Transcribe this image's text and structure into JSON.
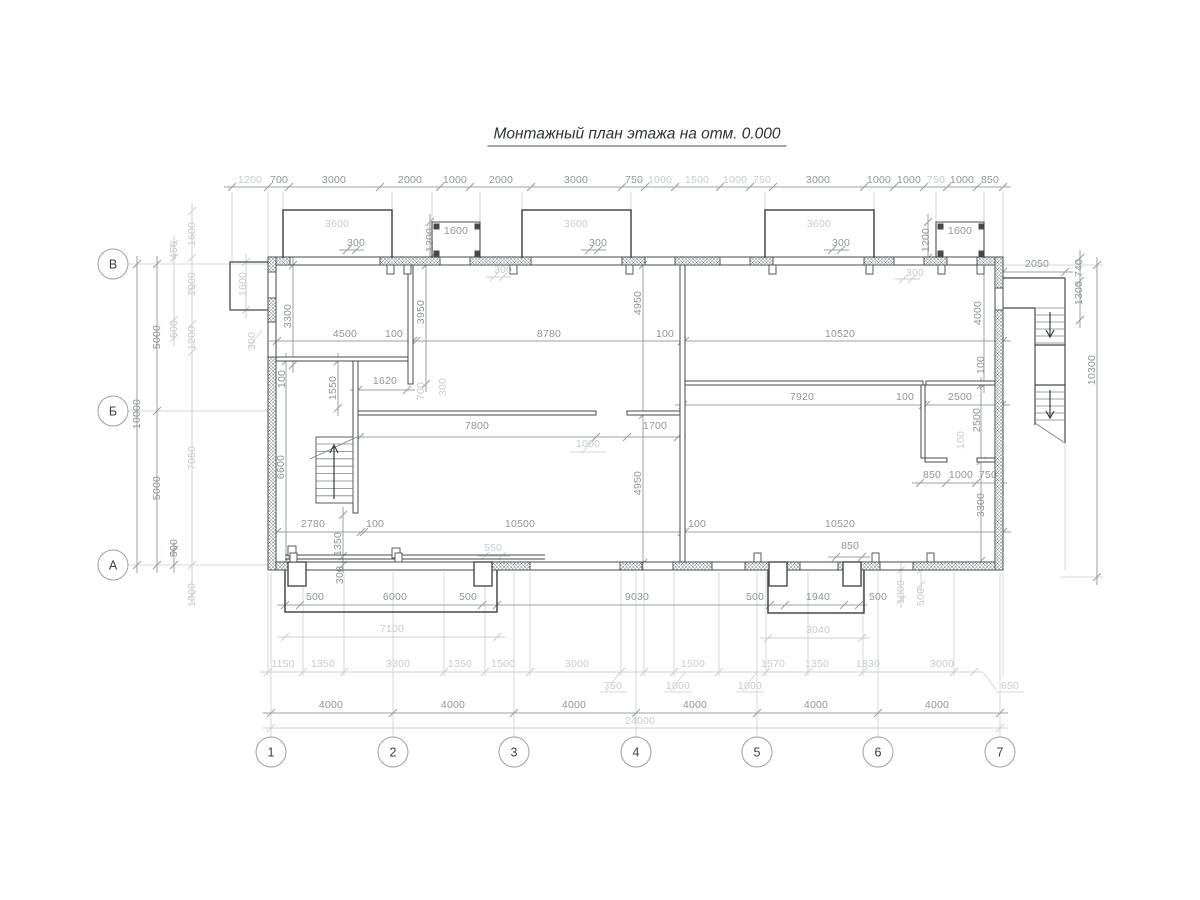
{
  "title": "Монтажный план этажа на отм. 0.000",
  "axes": {
    "vertical": [
      "В",
      "Б",
      "А"
    ],
    "horizontal": [
      "1",
      "2",
      "3",
      "4",
      "5",
      "6",
      "7"
    ]
  },
  "colors": {
    "wall_line": "#45494c",
    "dim_dark": "#8f9497",
    "dim_light": "#c7cbcd",
    "hatch": "#6e7376",
    "title_text": "#2e3234"
  },
  "labels": [
    {
      "t": "1200",
      "x": 250,
      "y": 180,
      "l": 1
    },
    {
      "t": "700",
      "x": 279,
      "y": 180
    },
    {
      "t": "3000",
      "x": 334,
      "y": 180
    },
    {
      "t": "2000",
      "x": 410,
      "y": 180
    },
    {
      "t": "1000",
      "x": 455,
      "y": 180
    },
    {
      "t": "2000",
      "x": 501,
      "y": 180
    },
    {
      "t": "3000",
      "x": 576,
      "y": 180
    },
    {
      "t": "750",
      "x": 634,
      "y": 180
    },
    {
      "t": "1000",
      "x": 660,
      "y": 180,
      "l": 1
    },
    {
      "t": "1500",
      "x": 697,
      "y": 180,
      "l": 1
    },
    {
      "t": "1000",
      "x": 735,
      "y": 180,
      "l": 1
    },
    {
      "t": "750",
      "x": 762,
      "y": 180,
      "l": 1
    },
    {
      "t": "3000",
      "x": 818,
      "y": 180
    },
    {
      "t": "1000",
      "x": 879,
      "y": 180
    },
    {
      "t": "1000",
      "x": 909,
      "y": 180
    },
    {
      "t": "750",
      "x": 936,
      "y": 180,
      "l": 1
    },
    {
      "t": "1000",
      "x": 962,
      "y": 180
    },
    {
      "t": "850",
      "x": 990,
      "y": 180
    },
    {
      "t": "3600",
      "x": 337,
      "y": 224,
      "l": 1
    },
    {
      "t": "3600",
      "x": 576,
      "y": 224,
      "l": 1
    },
    {
      "t": "3600",
      "x": 819,
      "y": 224,
      "l": 1
    },
    {
      "t": "300",
      "x": 356,
      "y": 243
    },
    {
      "t": "300",
      "x": 598,
      "y": 243
    },
    {
      "t": "300",
      "x": 841,
      "y": 243
    },
    {
      "t": "1600",
      "x": 456,
      "y": 231
    },
    {
      "t": "1200",
      "x": 430,
      "y": 240,
      "r": 1
    },
    {
      "t": "1600",
      "x": 960,
      "y": 231
    },
    {
      "t": "1200",
      "x": 926,
      "y": 240,
      "r": 1
    },
    {
      "t": "300",
      "x": 503,
      "y": 270,
      "l": 1
    },
    {
      "t": "300",
      "x": 915,
      "y": 273,
      "l": 1
    },
    {
      "t": "1600",
      "x": 243,
      "y": 284,
      "r": 1,
      "l": 1
    },
    {
      "t": "300",
      "x": 252,
      "y": 341,
      "r": 1,
      "l": 1
    },
    {
      "t": "10000",
      "x": 137,
      "y": 414,
      "r": 1
    },
    {
      "t": "5000",
      "x": 157,
      "y": 337,
      "r": 1
    },
    {
      "t": "5000",
      "x": 157,
      "y": 488,
      "r": 1
    },
    {
      "t": "450",
      "x": 174,
      "y": 250,
      "r": 1,
      "l": 1
    },
    {
      "t": "600",
      "x": 174,
      "y": 329,
      "r": 1,
      "l": 1
    },
    {
      "t": "500",
      "x": 174,
      "y": 548,
      "r": 1
    },
    {
      "t": "1600",
      "x": 192,
      "y": 234,
      "r": 1,
      "l": 1
    },
    {
      "t": "1000",
      "x": 192,
      "y": 284,
      "r": 1,
      "l": 1
    },
    {
      "t": "1200",
      "x": 192,
      "y": 338,
      "r": 1,
      "l": 1
    },
    {
      "t": "7050",
      "x": 192,
      "y": 458,
      "r": 1,
      "l": 1
    },
    {
      "t": "1000",
      "x": 192,
      "y": 595,
      "r": 1,
      "l": 1
    },
    {
      "t": "3300",
      "x": 288,
      "y": 316,
      "r": 1
    },
    {
      "t": "100",
      "x": 282,
      "y": 379,
      "r": 1
    },
    {
      "t": "6600",
      "x": 281,
      "y": 467,
      "r": 1
    },
    {
      "t": "1550",
      "x": 333,
      "y": 388,
      "r": 1
    },
    {
      "t": "1350",
      "x": 338,
      "y": 544,
      "r": 1
    },
    {
      "t": "300",
      "x": 340,
      "y": 575,
      "r": 1
    },
    {
      "t": "4500",
      "x": 345,
      "y": 334
    },
    {
      "t": "100",
      "x": 394,
      "y": 334
    },
    {
      "t": "8780",
      "x": 549,
      "y": 334
    },
    {
      "t": "100",
      "x": 665,
      "y": 334
    },
    {
      "t": "10520",
      "x": 840,
      "y": 334
    },
    {
      "t": "3950",
      "x": 421,
      "y": 312,
      "r": 1
    },
    {
      "t": "4950",
      "x": 638,
      "y": 303,
      "r": 1
    },
    {
      "t": "4000",
      "x": 978,
      "y": 313,
      "r": 1
    },
    {
      "t": "1620",
      "x": 385,
      "y": 381
    },
    {
      "t": "700",
      "x": 421,
      "y": 391,
      "r": 1,
      "l": 1
    },
    {
      "t": "300",
      "x": 443,
      "y": 387,
      "r": 1,
      "l": 1
    },
    {
      "t": "7800",
      "x": 477,
      "y": 426
    },
    {
      "t": "1700",
      "x": 655,
      "y": 426
    },
    {
      "t": "1000",
      "x": 588,
      "y": 444,
      "l": 1
    },
    {
      "t": "7920",
      "x": 802,
      "y": 397
    },
    {
      "t": "100",
      "x": 905,
      "y": 397
    },
    {
      "t": "2500",
      "x": 960,
      "y": 397
    },
    {
      "t": "100",
      "x": 981,
      "y": 365,
      "r": 1
    },
    {
      "t": "2500",
      "x": 977,
      "y": 420,
      "r": 1
    },
    {
      "t": "100",
      "x": 961,
      "y": 440,
      "r": 1,
      "l": 1
    },
    {
      "t": "4950",
      "x": 638,
      "y": 483,
      "r": 1
    },
    {
      "t": "3300",
      "x": 981,
      "y": 505,
      "r": 1
    },
    {
      "t": "2780",
      "x": 313,
      "y": 524
    },
    {
      "t": "100",
      "x": 375,
      "y": 524
    },
    {
      "t": "10500",
      "x": 520,
      "y": 524
    },
    {
      "t": "100",
      "x": 697,
      "y": 524
    },
    {
      "t": "10520",
      "x": 840,
      "y": 524
    },
    {
      "t": "850",
      "x": 932,
      "y": 475
    },
    {
      "t": "1000",
      "x": 961,
      "y": 475
    },
    {
      "t": "750",
      "x": 988,
      "y": 475
    },
    {
      "t": "850",
      "x": 850,
      "y": 546
    },
    {
      "t": "550",
      "x": 493,
      "y": 548,
      "l": 1
    },
    {
      "t": "500",
      "x": 315,
      "y": 597
    },
    {
      "t": "6000",
      "x": 395,
      "y": 597
    },
    {
      "t": "500",
      "x": 468,
      "y": 597
    },
    {
      "t": "9030",
      "x": 637,
      "y": 597
    },
    {
      "t": "500",
      "x": 755,
      "y": 597
    },
    {
      "t": "1940",
      "x": 818,
      "y": 597
    },
    {
      "t": "500",
      "x": 878,
      "y": 597
    },
    {
      "t": "7100",
      "x": 392,
      "y": 629,
      "l": 1
    },
    {
      "t": "3040",
      "x": 818,
      "y": 630,
      "l": 1
    },
    {
      "t": "1000",
      "x": 901,
      "y": 592,
      "r": 1,
      "l": 1
    },
    {
      "t": "500",
      "x": 921,
      "y": 597,
      "r": 1,
      "l": 1
    },
    {
      "t": "1150",
      "x": 283,
      "y": 664,
      "l": 1
    },
    {
      "t": "1350",
      "x": 323,
      "y": 664,
      "l": 1
    },
    {
      "t": "3300",
      "x": 398,
      "y": 664,
      "l": 1
    },
    {
      "t": "1350",
      "x": 460,
      "y": 664,
      "l": 1
    },
    {
      "t": "1500",
      "x": 503,
      "y": 664,
      "l": 1
    },
    {
      "t": "3000",
      "x": 577,
      "y": 664,
      "l": 1
    },
    {
      "t": "1500",
      "x": 693,
      "y": 664,
      "l": 1
    },
    {
      "t": "1570",
      "x": 773,
      "y": 664,
      "l": 1
    },
    {
      "t": "1350",
      "x": 817,
      "y": 664,
      "l": 1
    },
    {
      "t": "1830",
      "x": 868,
      "y": 664,
      "l": 1
    },
    {
      "t": "3000",
      "x": 942,
      "y": 664,
      "l": 1
    },
    {
      "t": "750",
      "x": 613,
      "y": 686,
      "l": 1
    },
    {
      "t": "1000",
      "x": 678,
      "y": 686,
      "l": 1
    },
    {
      "t": "1000",
      "x": 750,
      "y": 686,
      "l": 1
    },
    {
      "t": "650",
      "x": 1010,
      "y": 686,
      "l": 1
    },
    {
      "t": "4000",
      "x": 331,
      "y": 705
    },
    {
      "t": "4000",
      "x": 453,
      "y": 705
    },
    {
      "t": "4000",
      "x": 574,
      "y": 705
    },
    {
      "t": "4000",
      "x": 695,
      "y": 705
    },
    {
      "t": "4000",
      "x": 816,
      "y": 705
    },
    {
      "t": "4000",
      "x": 937,
      "y": 705
    },
    {
      "t": "24000",
      "x": 640,
      "y": 721,
      "l": 1
    },
    {
      "t": "2050",
      "x": 1037,
      "y": 264
    },
    {
      "t": "740",
      "x": 1079,
      "y": 268,
      "r": 1
    },
    {
      "t": "1300",
      "x": 1079,
      "y": 293,
      "r": 1
    },
    {
      "t": "10300",
      "x": 1092,
      "y": 370,
      "r": 1
    }
  ]
}
